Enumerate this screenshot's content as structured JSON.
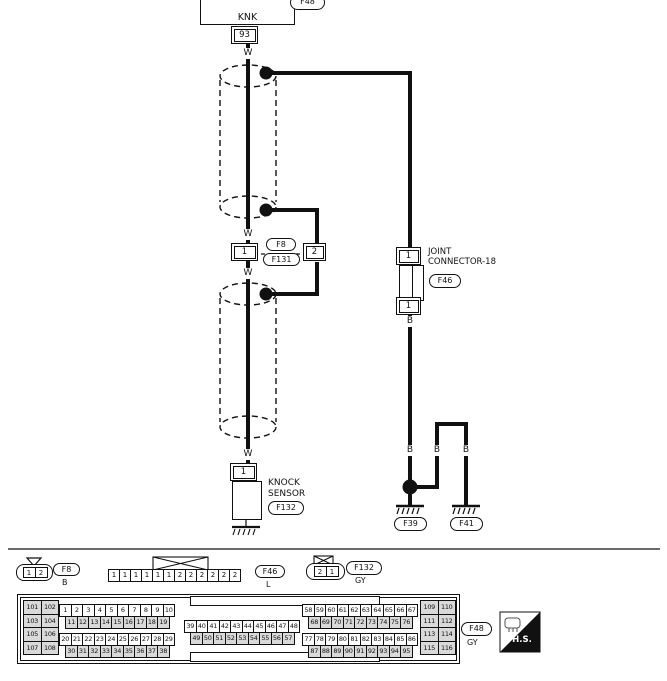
{
  "diagram": {
    "ecu_box": {
      "label": "KNK",
      "connector": "F48",
      "pin": "93"
    },
    "wire": {
      "white": "W",
      "black": "B"
    },
    "inline_connector": {
      "left_pin": "1",
      "right_pin": "2",
      "upper": "F8",
      "lower": "F131"
    },
    "joint_connector": {
      "line1": "JOINT",
      "line2": "CONNECTOR-18",
      "id": "F46",
      "top_pin": "1",
      "bottom_pin": "1"
    },
    "knock_sensor": {
      "pin": "1",
      "line1": "KNOCK",
      "line2": "SENSOR",
      "id": "F132"
    },
    "grounds": {
      "left_id": "F39",
      "right_id": "F41"
    }
  },
  "footer": {
    "f8": {
      "cells": [
        "1",
        "2"
      ],
      "id": "F8",
      "color": "B"
    },
    "f46": {
      "cells": [
        "1",
        "1",
        "1",
        "1",
        "1",
        "1",
        "2",
        "2",
        "2",
        "2",
        "2",
        "2"
      ],
      "id": "F46",
      "color": "L"
    },
    "f132": {
      "cells": [
        "2",
        "1"
      ],
      "id": "F132",
      "color": "GY"
    },
    "f48": {
      "id": "F48",
      "color": "GY",
      "left_block": [
        "101",
        "102",
        "103",
        "104",
        "105",
        "106",
        "107",
        "108"
      ],
      "right_block": [
        "109",
        "110",
        "111",
        "112",
        "113",
        "114",
        "115",
        "116"
      ],
      "row_a1": [
        "1",
        "2",
        "3",
        "4",
        "5",
        "6",
        "7",
        "8",
        "9",
        "10"
      ],
      "row_a2": [
        "11",
        "12",
        "13",
        "14",
        "15",
        "16",
        "17",
        "18",
        "19"
      ],
      "row_a3": [
        "20",
        "21",
        "22",
        "23",
        "24",
        "25",
        "26",
        "27",
        "28",
        "29"
      ],
      "row_a4": [
        "30",
        "31",
        "32",
        "33",
        "34",
        "35",
        "36",
        "37",
        "38"
      ],
      "row_b1": [
        "39",
        "40",
        "41",
        "42",
        "43",
        "44",
        "45",
        "46",
        "47",
        "48"
      ],
      "row_b2": [
        "49",
        "50",
        "51",
        "52",
        "53",
        "54",
        "55",
        "56",
        "57"
      ],
      "row_c1": [
        "58",
        "59",
        "60",
        "61",
        "62",
        "63",
        "64",
        "65",
        "66",
        "67"
      ],
      "row_c2": [
        "68",
        "69",
        "70",
        "71",
        "72",
        "73",
        "74",
        "75",
        "76"
      ],
      "row_c3": [
        "77",
        "78",
        "79",
        "80",
        "81",
        "82",
        "83",
        "84",
        "85",
        "86"
      ],
      "row_c4": [
        "87",
        "88",
        "89",
        "90",
        "91",
        "92",
        "93",
        "94",
        "95"
      ]
    },
    "hs": "H.S."
  }
}
